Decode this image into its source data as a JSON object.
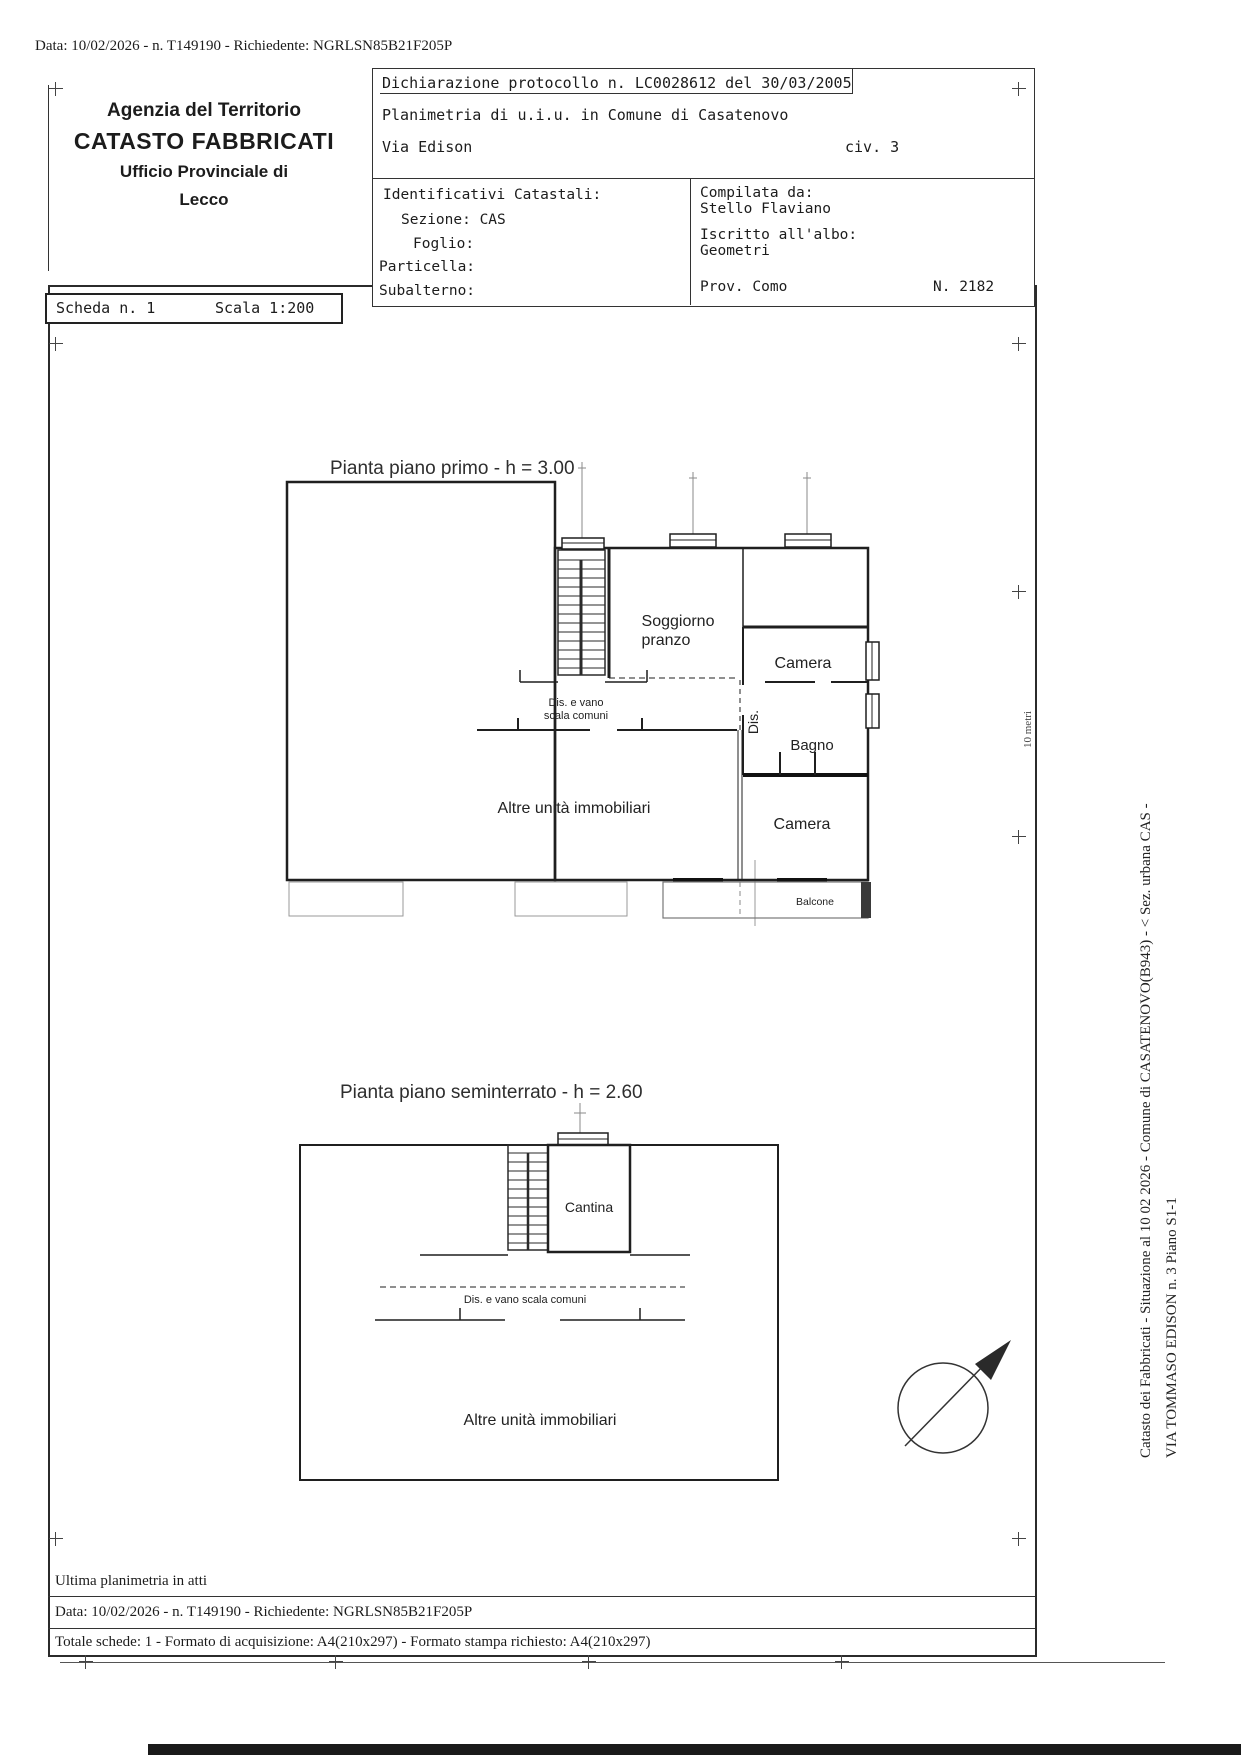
{
  "doc": {
    "top_line": "Data: 10/02/2026 - n. T149190 - Richiedente: NGRLSN85B21F205P",
    "agency": {
      "l1": "Agenzia del Territorio",
      "l2": "CATASTO FABBRICATI",
      "l3": "Ufficio Provinciale di",
      "l4": "Lecco"
    },
    "declaration": {
      "protocol": "Dichiarazione protocollo n. LC0028612 del  30/03/2005",
      "planimetria": "Planimetria di u.i.u. in Comune di Casatenovo",
      "street": "Via Edison",
      "civ": "civ. 3"
    },
    "cadastral": {
      "title": "Identificativi Catastali:",
      "sezione": "Sezione: CAS",
      "foglio": "Foglio:",
      "particella": "Particella:",
      "subalterno": "Subalterno:"
    },
    "compiler": {
      "compilata": "Compilata da:",
      "name": "Stello Flaviano",
      "iscritto": "Iscritto all'albo:",
      "albo": "Geometri",
      "prov": "Prov. Como",
      "num": "N. 2182"
    },
    "scheda": {
      "label": "Scheda n. 1",
      "scala": "Scala 1:200"
    },
    "footer": {
      "ultima": "Ultima planimetria in atti",
      "data_line": "Data: 10/02/2026 - n. T149190 - Richiedente: NGRLSN85B21F205P",
      "totale_line": "Totale schede: 1 - Formato di acquisizione: A4(210x297)  - Formato stampa richiesto: A4(210x297)"
    }
  },
  "plan_first": {
    "title": "Pianta piano primo - h = 3.00",
    "soggiorno_1": "Soggiorno",
    "soggiorno_2": "pranzo",
    "camera_top": "Camera",
    "dis": "Dis.",
    "bagno": "Bagno",
    "camera_bottom": "Camera",
    "altre": "Altre unità immobiliari",
    "vano_1": "Dis. e vano",
    "vano_2": "scala comuni",
    "balcone": "Balcone"
  },
  "plan_basement": {
    "title": "Pianta piano seminterrato - h = 2.60",
    "cantina": "Cantina",
    "vano": "Dis. e vano scala comuni",
    "altre": "Altre unità immobiliari"
  },
  "side": {
    "vertical_1": "Catasto dei Fabbricati - Situazione al 10 02 2026 - Comune di CASATENOVO(B943) - < Sez. urbana CAS -",
    "vertical_2": "VIA TOMMASO EDISON n. 3 Piano S1-1",
    "scale_label": "10 metri"
  },
  "colors": {
    "ink": "#1c1c1c",
    "line": "#333333"
  }
}
